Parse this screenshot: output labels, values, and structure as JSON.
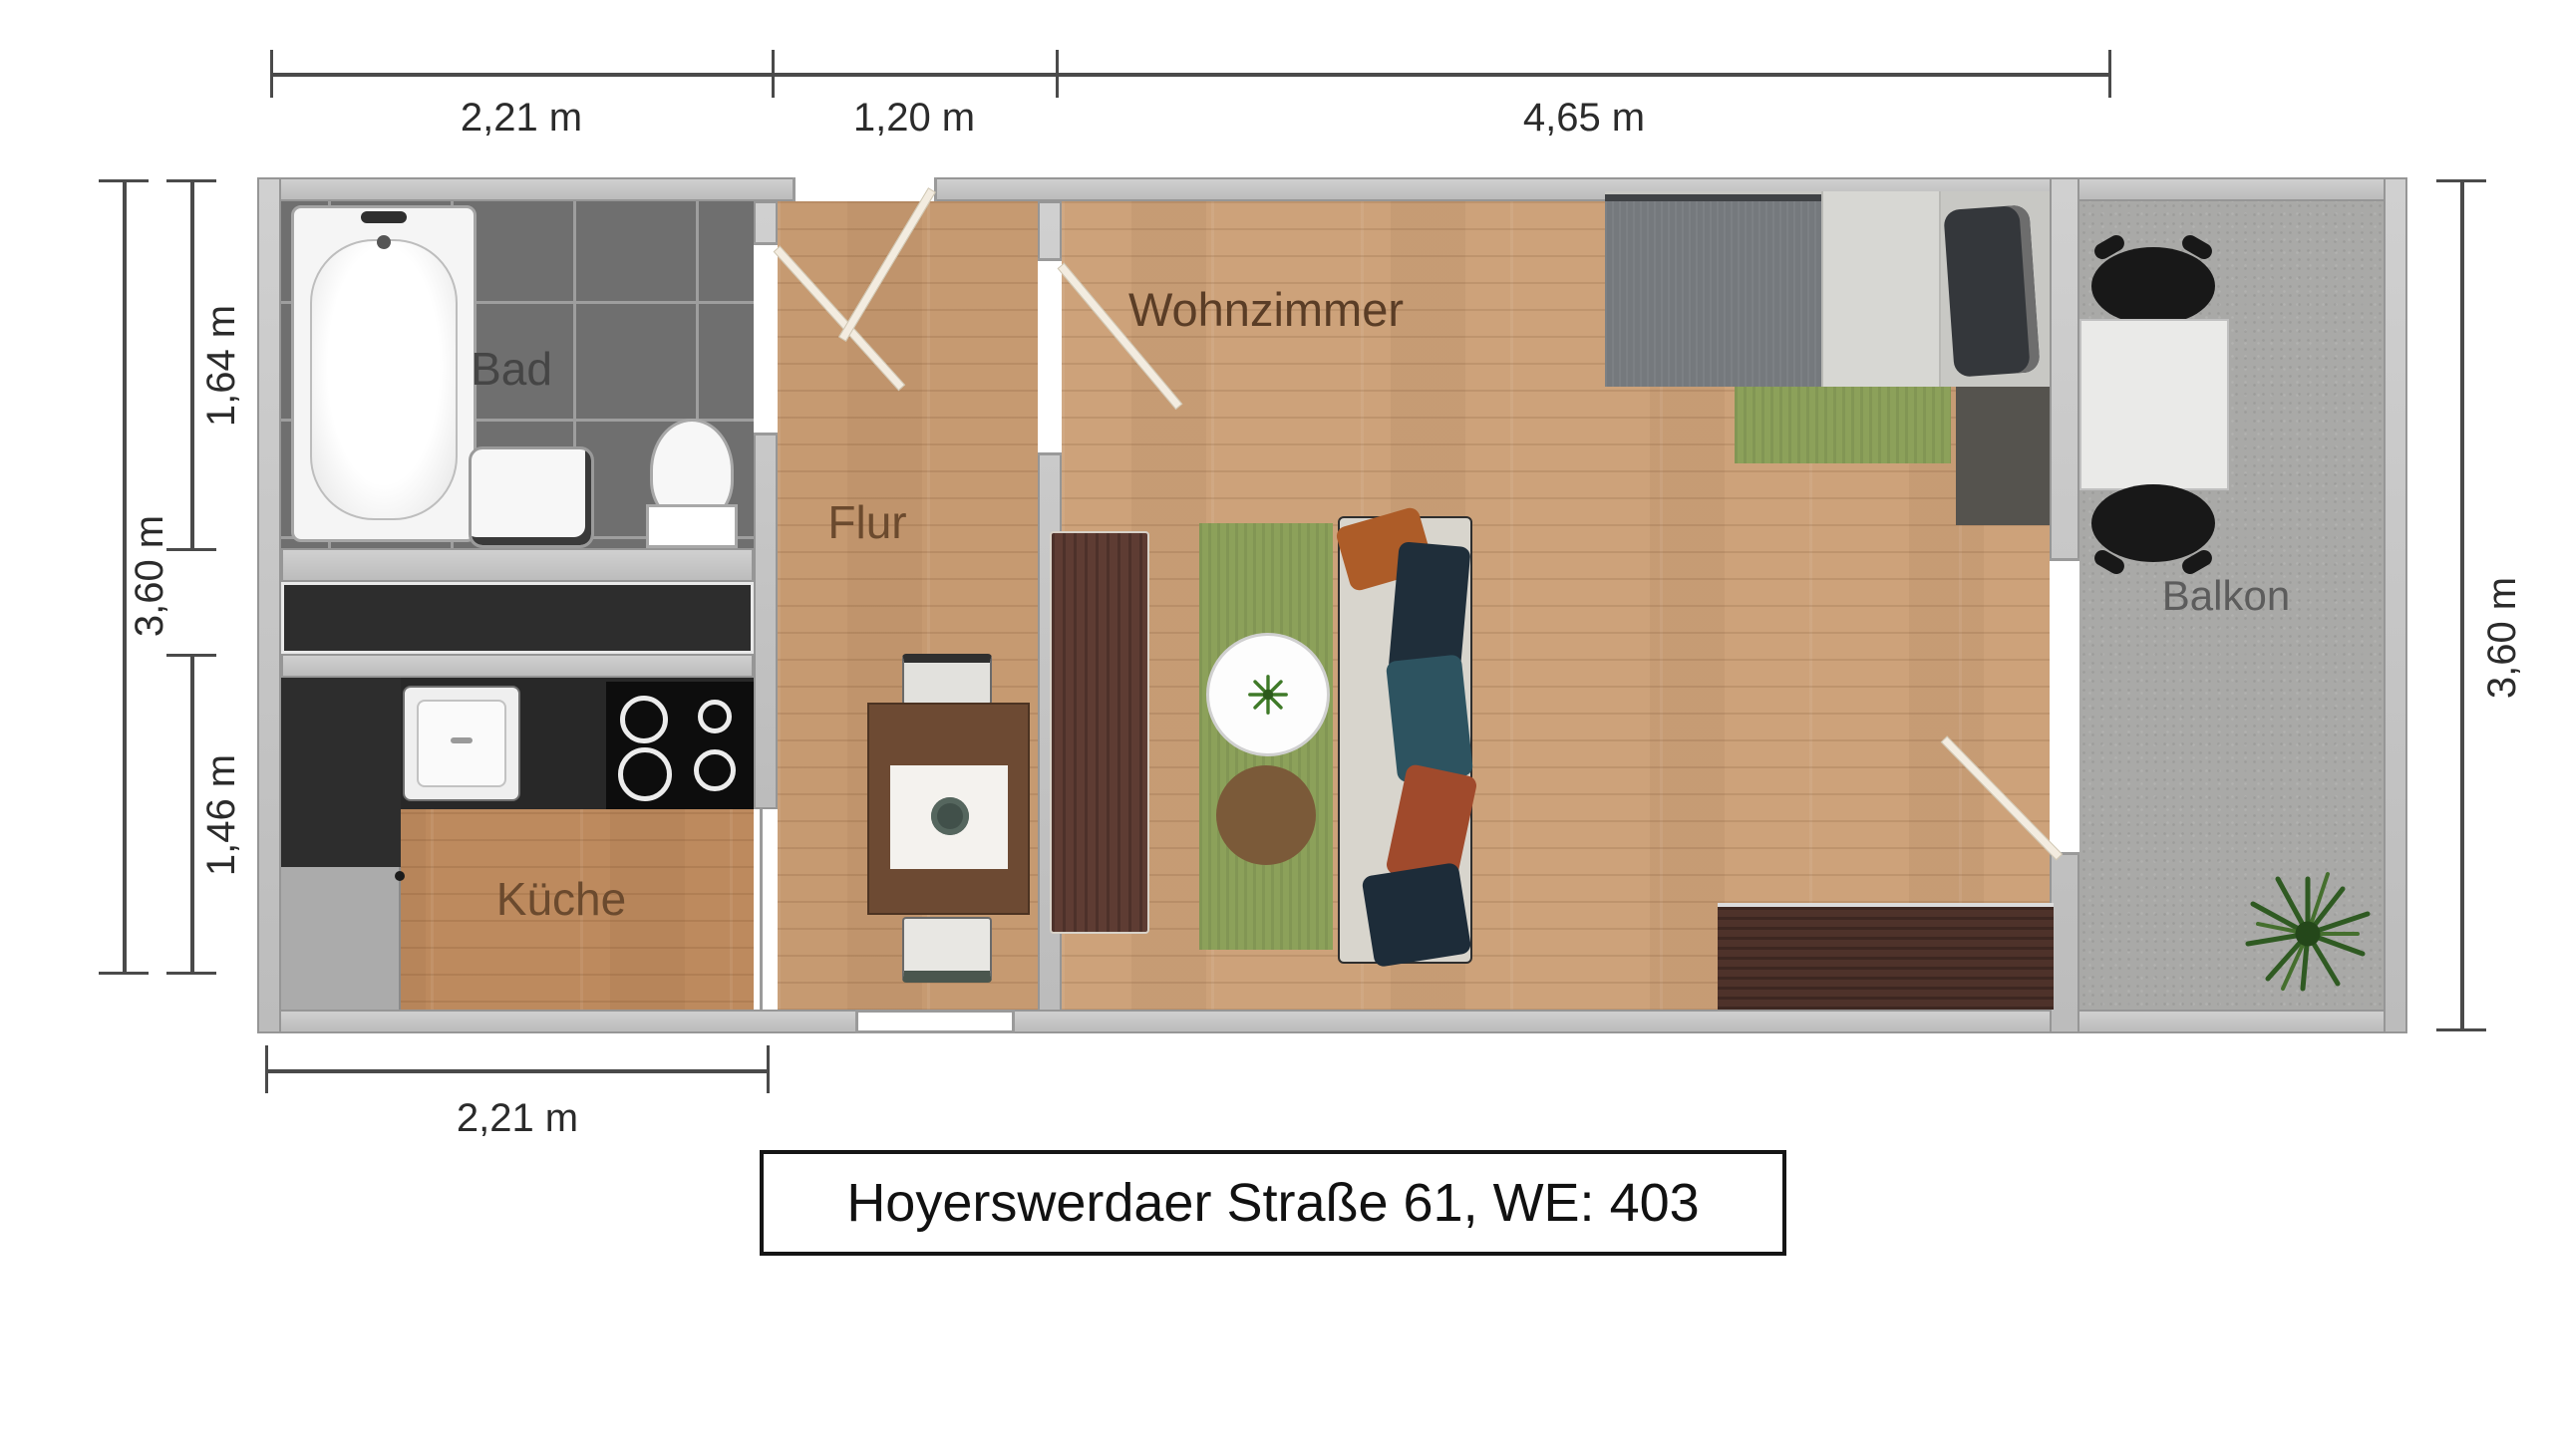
{
  "title": {
    "text": "Hoyerswerdaer Straße 61, WE: 403"
  },
  "rooms": {
    "bad": {
      "label": "Bad"
    },
    "kueche": {
      "label": "Küche"
    },
    "flur": {
      "label": "Flur"
    },
    "wohnzimmer": {
      "label": "Wohnzimmer"
    },
    "balkon": {
      "label": "Balkon"
    }
  },
  "dimensions": {
    "top": [
      {
        "label": "2,21 m"
      },
      {
        "label": "1,20 m"
      },
      {
        "label": "4,65 m"
      }
    ],
    "left_outer": {
      "label": "3,60 m"
    },
    "left_inner": [
      {
        "label": "1,64 m"
      },
      {
        "label": "1,46 m"
      }
    ],
    "right": {
      "label": "3,60 m"
    },
    "bottom": {
      "label": "2,21 m"
    }
  },
  "colors": {
    "wall": "#c6c6c6",
    "wall_edge": "#969696",
    "bad_tile": "#6f6f6f",
    "shaft": "#2d2d2d",
    "wood_flur": "#c69a71",
    "wood_kueche": "#bd8a5e",
    "wood_wohnzimmer": "#cda27a",
    "balcony_concrete": "#a9a9a7",
    "kitchen_counter": "#282828",
    "rug_green": "#8ca15a",
    "rug_runner_brown": "#5e3c33",
    "rug_dark_brown": "#4e322a",
    "dim_line": "#4a4a4a",
    "room_label_brown": "#6b4a2e",
    "room_label_gray": "#5c5c5c"
  },
  "icons": {
    "bathtub": "bathtub-icon",
    "toilet": "toilet-icon",
    "washbasin": "washbasin-icon",
    "stove": "stove-icon",
    "sink": "kitchen-sink-icon",
    "door_swing": "door-swing-icon",
    "plant": "plant-icon",
    "sofa": "sofa-icon",
    "bed": "bed-icon",
    "table": "table-icon",
    "chair": "chair-icon"
  }
}
